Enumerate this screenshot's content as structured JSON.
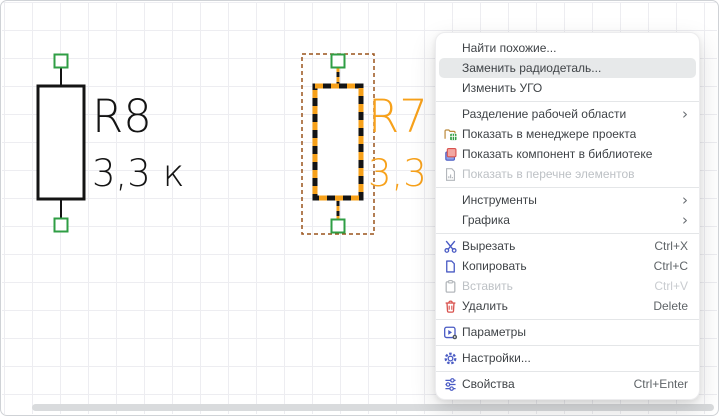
{
  "canvas": {
    "components": [
      {
        "ref": "R8",
        "value": "3,3 к",
        "state": "normal"
      },
      {
        "ref": "R7",
        "value": "3,3 к",
        "state": "selected"
      }
    ]
  },
  "context_menu": {
    "items": [
      {
        "name": "find-similar",
        "label": "Найти похожие..."
      },
      {
        "name": "replace-component",
        "label": "Заменить радиодеталь...",
        "highlighted": true
      },
      {
        "name": "edit-symbol",
        "label": "Изменить УГО"
      },
      {
        "type": "separator"
      },
      {
        "name": "split-workspace",
        "label": "Разделение рабочей области",
        "submenu": true
      },
      {
        "name": "show-in-project-manager",
        "label": "Показать в менеджере проекта",
        "icon": "project-manager-icon"
      },
      {
        "name": "show-component-in-library",
        "label": "Показать компонент в библиотеке",
        "icon": "library-icon"
      },
      {
        "name": "show-in-element-list",
        "label": "Показать в перечне элементов",
        "icon": "element-list-icon",
        "disabled": true
      },
      {
        "type": "separator"
      },
      {
        "name": "tools",
        "label": "Инструменты",
        "submenu": true
      },
      {
        "name": "graphics",
        "label": "Графика",
        "submenu": true
      },
      {
        "type": "separator"
      },
      {
        "name": "cut",
        "label": "Вырезать",
        "icon": "scissors-icon",
        "shortcut": "Ctrl+X"
      },
      {
        "name": "copy",
        "label": "Копировать",
        "icon": "copy-icon",
        "shortcut": "Ctrl+C"
      },
      {
        "name": "paste",
        "label": "Вставить",
        "icon": "paste-icon",
        "shortcut": "Ctrl+V",
        "disabled": true
      },
      {
        "name": "delete",
        "label": "Удалить",
        "icon": "trash-icon",
        "shortcut": "Delete"
      },
      {
        "type": "separator"
      },
      {
        "name": "parameters",
        "label": "Параметры",
        "icon": "parameters-icon"
      },
      {
        "type": "separator"
      },
      {
        "name": "settings",
        "label": "Настройки...",
        "icon": "settings-gear-icon"
      },
      {
        "type": "separator"
      },
      {
        "name": "properties",
        "label": "Свойства",
        "icon": "sliders-icon",
        "shortcut": "Ctrl+Enter"
      }
    ]
  },
  "colors": {
    "schematic_stroke": "#141414",
    "selection_orange": "#f7a11a",
    "selection_dash_brown": "#9a541c",
    "pin_green": "#2f9e44",
    "menu_hover_bg": "#e7e9ea",
    "icon_blue": "#4a5bc4",
    "icon_red": "#d9534f",
    "grid_line": "#ededf1"
  }
}
